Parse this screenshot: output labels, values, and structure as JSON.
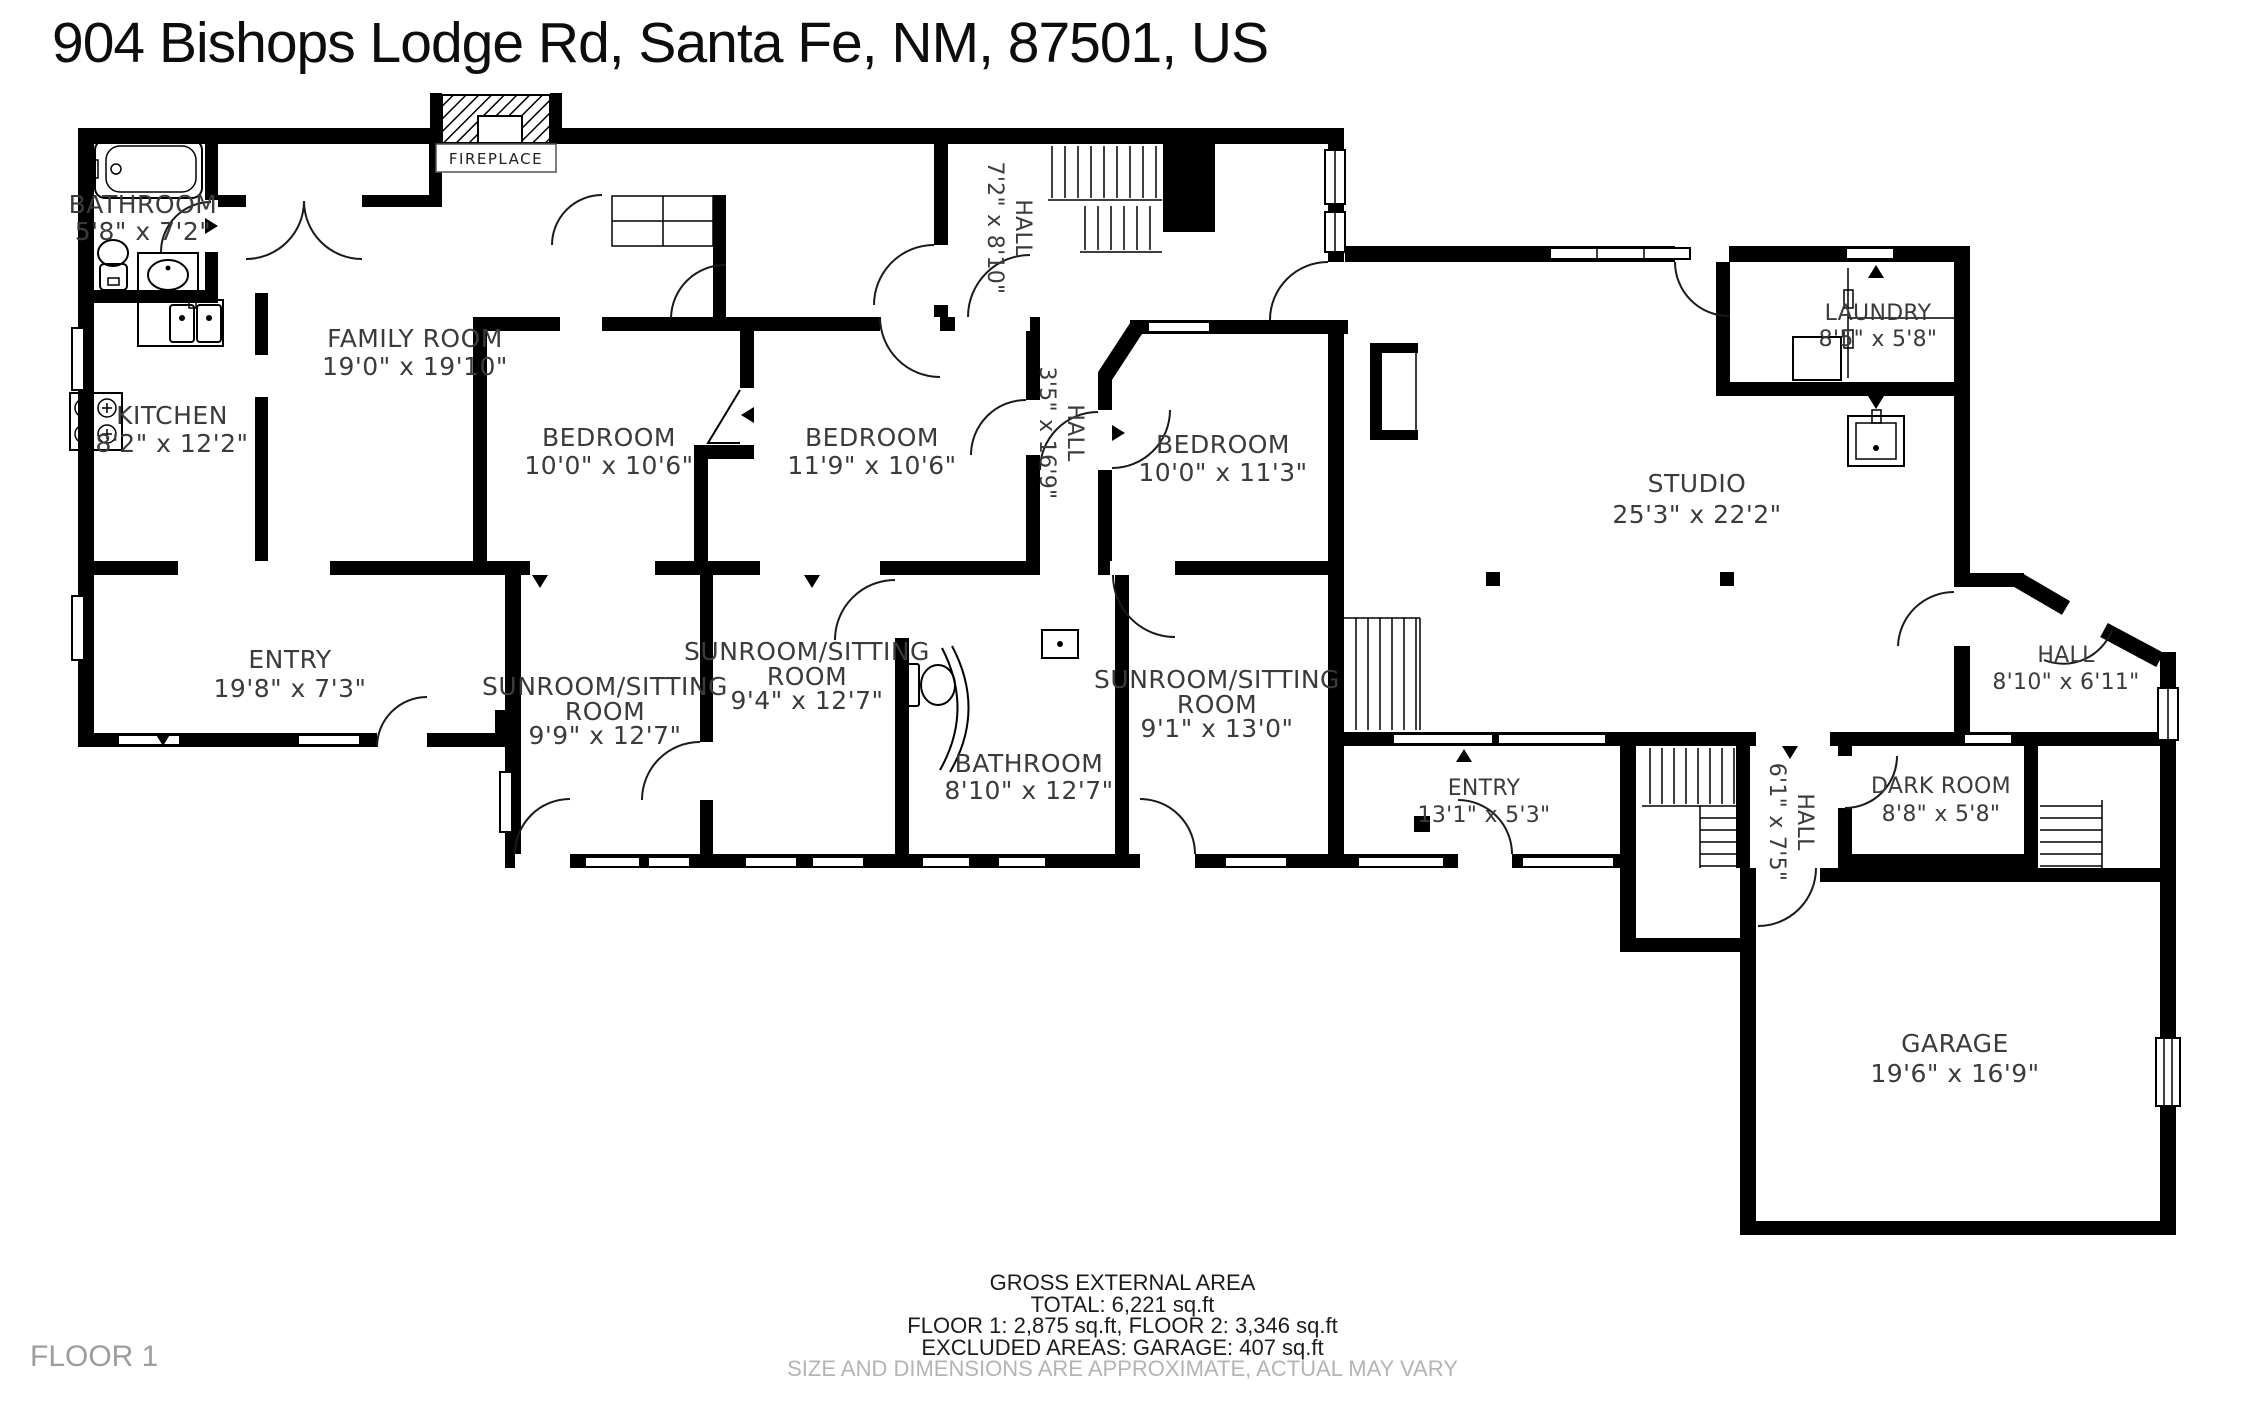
{
  "title": "904 Bishops Lodge Rd, Santa Fe, NM, 87501, US",
  "floor_label": "FLOOR 1",
  "fireplace_label": "FIREPLACE",
  "footer": {
    "line1": "GROSS EXTERNAL AREA",
    "line2": "TOTAL: 6,221 sq.ft",
    "line3": "FLOOR 1: 2,875 sq.ft, FLOOR 2: 3,346 sq.ft",
    "line4": "EXCLUDED AREAS: GARAGE: 407 s q.ft",
    "disclaimer": "SIZE AND DIMENSIONS ARE APPROXIMATE, ACTUAL MAY VARY"
  },
  "rooms": [
    {
      "name": "BATHROOM",
      "dims": "5'8\" x 7'2\""
    },
    {
      "name": "KITCHEN",
      "dims": "8'2\" x 12'2\""
    },
    {
      "name": "FAMILY ROOM",
      "dims": "19'0\" x 19'10\""
    },
    {
      "name": "HALL",
      "dims": "7'2\" x 8'10\""
    },
    {
      "name": "BEDROOM",
      "dims": "10'0\" x 10'6\""
    },
    {
      "name": "BEDROOM",
      "dims": "11'9\" x 10'6\""
    },
    {
      "name": "HALL",
      "dims": "3'5\" x 16'9\""
    },
    {
      "name": "BEDROOM",
      "dims": "10'0\" x 11'3\""
    },
    {
      "name": "LAUNDRY",
      "dims": "8'5\" x 5'8\""
    },
    {
      "name": "STUDIO",
      "dims": "25'3\" x 22'2\""
    },
    {
      "name": "ENTRY",
      "dims": "19'8\" x 7'3\""
    },
    {
      "name": "SUNROOM/SITTING",
      "name2": "ROOM",
      "dims": "9'9\" x 12'7\""
    },
    {
      "name": "SUNROOM/SITTING",
      "name2": "ROOM",
      "dims": "9'4\" x 12'7\""
    },
    {
      "name": "BATHROOM",
      "dims": "8'10\" x 12'7\""
    },
    {
      "name": "SUNROOM/SITTING",
      "name2": "ROOM",
      "dims": "9'1\" x 13'0\""
    },
    {
      "name": "ENTRY",
      "dims": "13'1\" x 5'3\""
    },
    {
      "name": "HALL",
      "dims": "6'1\" x 7'5\""
    },
    {
      "name": "DARK ROOM",
      "dims": "8'8\" x 5'8\""
    },
    {
      "name": "HALL",
      "dims": "8'10\" x 6'11\""
    },
    {
      "name": "GARAGE",
      "dims": "19'6\" x 16'9\""
    }
  ]
}
